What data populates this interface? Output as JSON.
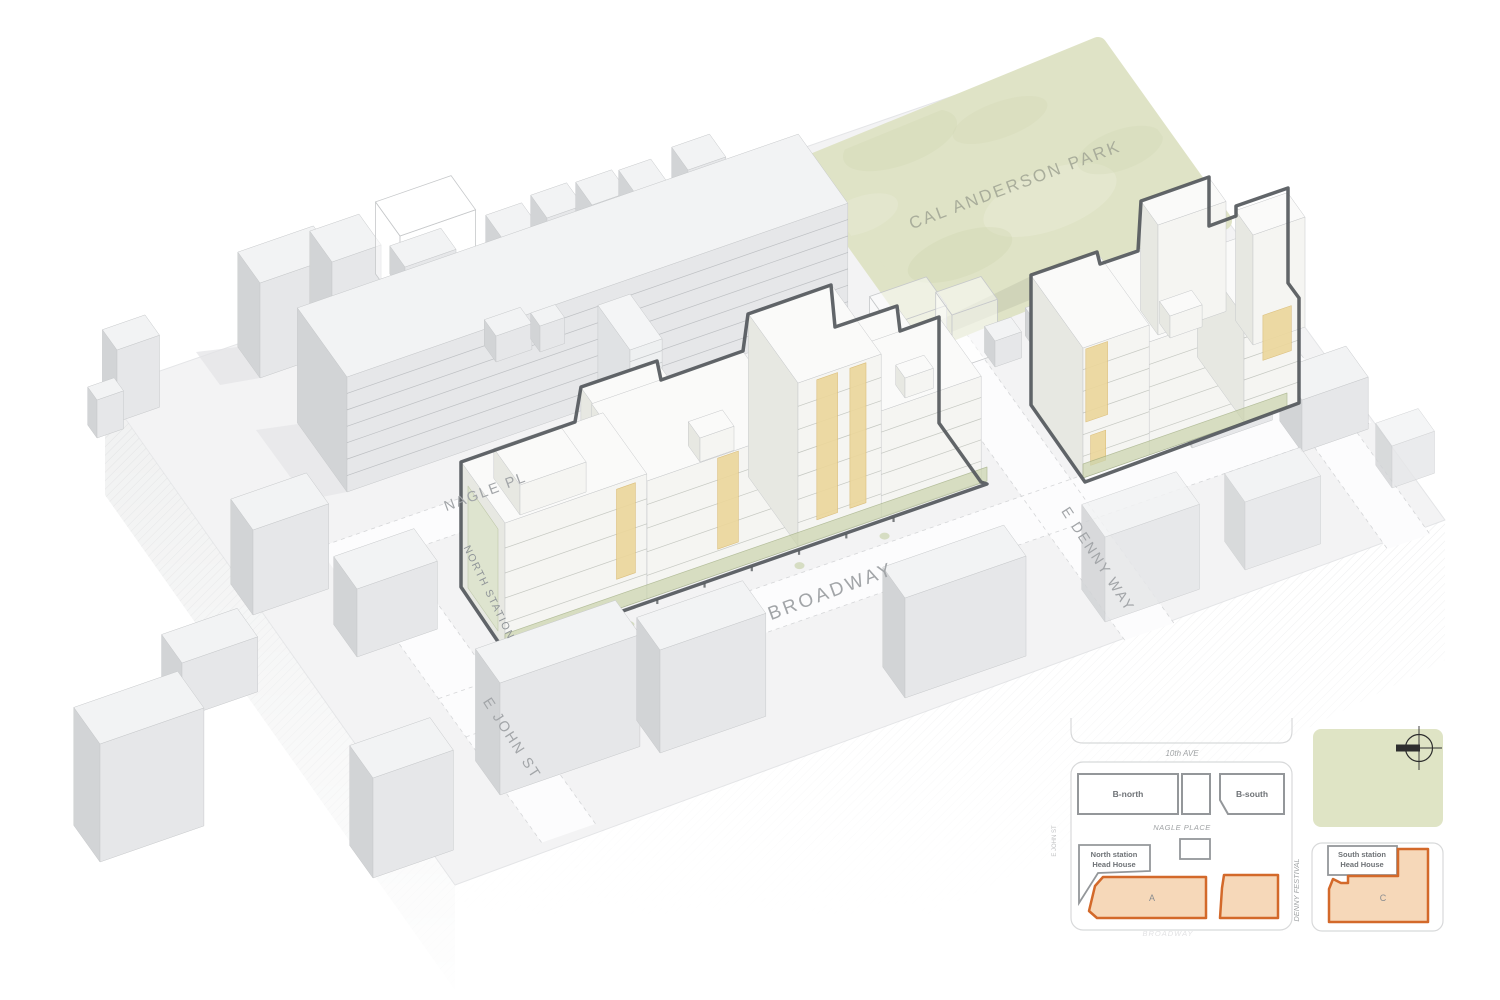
{
  "labels": {
    "park": "CAL ANDERSON PARK",
    "nagle_pl": "NAGLE PL",
    "broadway": "BROADWAY",
    "e_john_st": "E JOHN ST",
    "e_denny_way": "E DENNY WAY",
    "north_station": "NORTH STATION"
  },
  "keyplan": {
    "streets": {
      "tenth_ave": "10th AVE",
      "nagle_place": "NAGLE PLACE",
      "denny_festival": "DENNY FESTIVAL",
      "broadway_faint": "BROADWAY",
      "e_john_st": "E JOHN ST"
    },
    "parcels": {
      "b_north": "B-north",
      "b_south": "B-south",
      "site_a": "A",
      "site_c": "C"
    },
    "stations": {
      "north_line1": "North station",
      "north_line2": "Head House",
      "south_line1": "South station",
      "south_line2": "Head House"
    }
  },
  "colors": {
    "streetText": "#a2a5a8",
    "stationText": "#8f9498",
    "parkText": "#a9ad9b",
    "outline": "#54585c",
    "orange": "#d3692a",
    "orangeFill": "#f6d8b9",
    "parkGreen": "#dfe3c6",
    "parkShade": "#b9bfa6",
    "keyplanGreen": "#dfe4c5",
    "kpFrame": "#d8d9da",
    "kpGray": "#94979a",
    "kpStreetText": "#9fa2a4",
    "kpBuildingText": "#6e7276",
    "kpSiteText": "#8a8d90",
    "kpFaintText": "#e2e2e4",
    "kpTinyText": "#bfc0c2",
    "amber": "#ecd79b",
    "amberEdge": "#d9ba72",
    "storefront": "#cbd4ad",
    "glassGreen": "#dde4cc",
    "ground": "#f3f3f4",
    "street": "#fcfcfd",
    "hatch": "#d8d9db",
    "ctxTop": "#f2f3f4",
    "ctxFront": "#e6e7e9",
    "ctxSide": "#d2d4d6",
    "siteTop": "#fafaf9",
    "siteFront": "#f5f5f2",
    "siteSide": "#e7e8e2",
    "compass": "#2e2e2e"
  }
}
